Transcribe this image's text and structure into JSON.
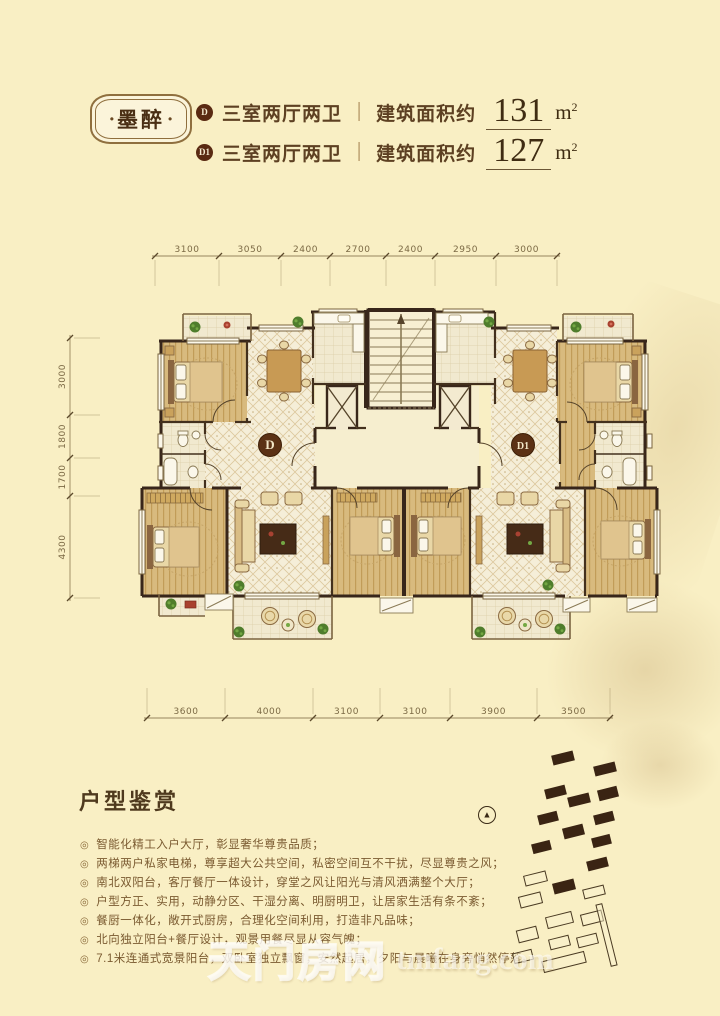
{
  "page": {
    "background": "#f9efc4"
  },
  "header": {
    "badge_text": "墨醉",
    "units": [
      {
        "code": "D",
        "rooms": "三室两厅两卫",
        "divider": "|",
        "area_label": "建筑面积约",
        "area_value": "131",
        "area_unit": "m",
        "area_unit_sup": "2"
      },
      {
        "code": "D1",
        "rooms": "三室两厅两卫",
        "divider": "|",
        "area_label": "建筑面积约",
        "area_value": "127",
        "area_unit": "m",
        "area_unit_sup": "2"
      }
    ]
  },
  "floorplan": {
    "unit_labels": [
      {
        "id": "D",
        "x": 215,
        "y": 207
      },
      {
        "id": "D1",
        "x": 468,
        "y": 207
      }
    ],
    "dimensions": {
      "top": {
        "labels": [
          "3100",
          "3050",
          "2400",
          "2700",
          "2400",
          "2950",
          "3000"
        ]
      },
      "left": {
        "labels": [
          "3000",
          "1800",
          "1700",
          "4300"
        ]
      },
      "bottom": {
        "labels": [
          "3600",
          "4000",
          "3100",
          "3100",
          "3900",
          "3500"
        ]
      }
    }
  },
  "features": {
    "title": "户型鉴赏",
    "bullet": "◎",
    "items": [
      "智能化精工入户大厅，彰显奢华尊贵品质；",
      "两梯两户私家电梯，尊享超大公共空间，私密空间互不干扰，尽显尊贵之风；",
      "南北双阳台，客厅餐厅一体设计，穿堂之风让阳光与清风洒满整个大厅；",
      "户型方正、实用，动静分区、干湿分离、明厨明卫，让居家生活有条不紊；",
      "餐厨一体化，敞开式厨房，合理化空间利用，打造非凡品味；",
      "北向独立阳台+餐厅设计，观景用餐尽显从容气魄；",
      "7.1米连通式宽景阳台，双卧室独立飘窗，安然起居，夕阳与晨曦在身旁悄然停落。"
    ]
  },
  "siteplan": {
    "north_symbol": "▲",
    "blocks": [
      {
        "x": 552,
        "y": 753,
        "w": 22,
        "h": 10,
        "f": 1
      },
      {
        "x": 594,
        "y": 764,
        "w": 22,
        "h": 10,
        "f": 1
      },
      {
        "x": 545,
        "y": 787,
        "w": 21,
        "h": 10,
        "f": 1
      },
      {
        "x": 568,
        "y": 795,
        "w": 22,
        "h": 10,
        "f": 1
      },
      {
        "x": 598,
        "y": 788,
        "w": 20,
        "h": 11,
        "f": 1
      },
      {
        "x": 538,
        "y": 813,
        "w": 20,
        "h": 10,
        "f": 1
      },
      {
        "x": 563,
        "y": 826,
        "w": 21,
        "h": 11,
        "f": 1
      },
      {
        "x": 594,
        "y": 813,
        "w": 20,
        "h": 10,
        "f": 1
      },
      {
        "x": 532,
        "y": 842,
        "w": 19,
        "h": 10,
        "f": 1
      },
      {
        "x": 592,
        "y": 836,
        "w": 19,
        "h": 10,
        "f": 1
      },
      {
        "x": 587,
        "y": 859,
        "w": 21,
        "h": 10,
        "f": 1
      },
      {
        "x": 553,
        "y": 881,
        "w": 22,
        "h": 11,
        "f": 1
      },
      {
        "x": 524,
        "y": 873,
        "w": 23,
        "h": 11,
        "f": 0
      },
      {
        "x": 583,
        "y": 887,
        "w": 22,
        "h": 10,
        "f": 0
      },
      {
        "x": 519,
        "y": 894,
        "w": 23,
        "h": 12,
        "f": 0
      },
      {
        "x": 546,
        "y": 914,
        "w": 27,
        "h": 12,
        "f": 0
      },
      {
        "x": 581,
        "y": 912,
        "w": 22,
        "h": 12,
        "f": 0
      },
      {
        "x": 517,
        "y": 928,
        "w": 21,
        "h": 13,
        "f": 0
      },
      {
        "x": 549,
        "y": 937,
        "w": 21,
        "h": 11,
        "f": 0
      },
      {
        "x": 577,
        "y": 935,
        "w": 21,
        "h": 11,
        "f": 0
      },
      {
        "x": 513,
        "y": 951,
        "w": 20,
        "h": 11,
        "f": 0
      },
      {
        "x": 542,
        "y": 956,
        "w": 44,
        "h": 12,
        "f": 0
      },
      {
        "x": 603,
        "y": 903,
        "w": 7,
        "h": 64,
        "f": 0
      }
    ]
  },
  "watermark": {
    "cjk": "天门房网",
    "latin": "tmfang.com"
  }
}
